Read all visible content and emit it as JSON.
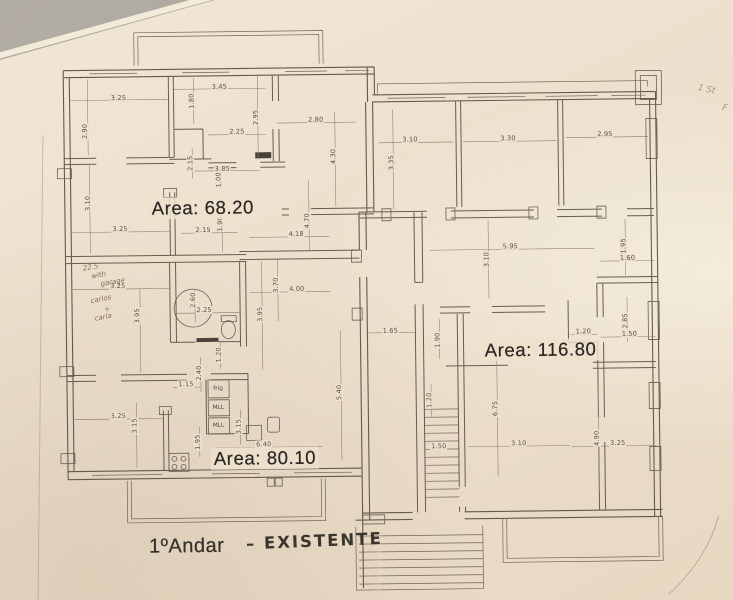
{
  "page": {
    "background_color": "#a6a199",
    "paper_color": "#ece0cd",
    "ink_color": "#635a4e"
  },
  "title": {
    "printed": "1ºAndar",
    "handwritten": "– EXISTENTE"
  },
  "area_labels": [
    {
      "t": "Area:  68.20",
      "x": 204,
      "y": 206
    },
    {
      "t": "Area:  116.80",
      "x": 540,
      "y": 352
    },
    {
      "t": "Area:  80.10",
      "x": 263,
      "y": 457
    }
  ],
  "dimension_labels": [
    {
      "t": "3.25",
      "x": 121,
      "y": 95
    },
    {
      "t": "2.90",
      "x": 87,
      "y": 128,
      "v": true
    },
    {
      "t": "3.45",
      "x": 222,
      "y": 85
    },
    {
      "t": "1.80",
      "x": 194,
      "y": 99,
      "v": true
    },
    {
      "t": "2.95",
      "x": 258,
      "y": 116,
      "v": true
    },
    {
      "t": "2.25",
      "x": 239,
      "y": 130
    },
    {
      "t": "2.80",
      "x": 318,
      "y": 119
    },
    {
      "t": "4.30",
      "x": 335,
      "y": 156,
      "v": true
    },
    {
      "t": "2.15",
      "x": 192,
      "y": 161,
      "v": true
    },
    {
      "t": "3.85",
      "x": 224,
      "y": 167
    },
    {
      "t": "1.00",
      "x": 220,
      "y": 178,
      "v": true
    },
    {
      "t": "3.10",
      "x": 89,
      "y": 200,
      "v": true
    },
    {
      "t": "3.25",
      "x": 121,
      "y": 226
    },
    {
      "t": "2.15",
      "x": 204,
      "y": 228
    },
    {
      "t": "1.90",
      "x": 221,
      "y": 222,
      "v": true
    },
    {
      "t": "4.18",
      "x": 297,
      "y": 233
    },
    {
      "t": "4.70",
      "x": 308,
      "y": 220,
      "v": true
    },
    {
      "t": "3.70",
      "x": 276,
      "y": 284,
      "v": true
    },
    {
      "t": "4.00",
      "x": 297,
      "y": 288
    },
    {
      "t": "3.25",
      "x": 118,
      "y": 283
    },
    {
      "t": "3.95",
      "x": 137,
      "y": 313,
      "v": true
    },
    {
      "t": "2.60",
      "x": 193,
      "y": 298,
      "v": true
    },
    {
      "t": "2.25",
      "x": 204,
      "y": 308
    },
    {
      "t": "3.95",
      "x": 260,
      "y": 313,
      "v": true
    },
    {
      "t": "1.20",
      "x": 218,
      "y": 353,
      "v": true
    },
    {
      "t": "2.40",
      "x": 198,
      "y": 371,
      "v": true
    },
    {
      "t": "1.15",
      "x": 185,
      "y": 382
    },
    {
      "t": "1.95",
      "x": 196,
      "y": 440,
      "v": true
    },
    {
      "t": "3.15",
      "x": 237,
      "y": 425,
      "v": true
    },
    {
      "t": "6.40",
      "x": 262,
      "y": 443
    },
    {
      "t": "3.25",
      "x": 117,
      "y": 413
    },
    {
      "t": "3.15",
      "x": 133,
      "y": 423,
      "v": true
    },
    {
      "t": "5.40",
      "x": 338,
      "y": 392,
      "v": true
    },
    {
      "t": "1.65",
      "x": 390,
      "y": 331
    },
    {
      "t": "1.90",
      "x": 437,
      "y": 341,
      "v": true
    },
    {
      "t": "3.10",
      "x": 412,
      "y": 140
    },
    {
      "t": "3.30",
      "x": 510,
      "y": 140
    },
    {
      "t": "2.95",
      "x": 607,
      "y": 137
    },
    {
      "t": "3.35",
      "x": 393,
      "y": 163,
      "v": true
    },
    {
      "t": "5.95",
      "x": 511,
      "y": 248
    },
    {
      "t": "3.10",
      "x": 487,
      "y": 261,
      "v": true
    },
    {
      "t": "1.95",
      "x": 624,
      "y": 249,
      "v": true
    },
    {
      "t": "1.60",
      "x": 628,
      "y": 261
    },
    {
      "t": "1.20",
      "x": 583,
      "y": 334
    },
    {
      "t": "2.85",
      "x": 625,
      "y": 324,
      "v": true
    },
    {
      "t": "1.50",
      "x": 629,
      "y": 337
    },
    {
      "t": "6.75",
      "x": 494,
      "y": 410,
      "v": true
    },
    {
      "t": "1.20",
      "x": 428,
      "y": 401,
      "v": true
    },
    {
      "t": "1.50",
      "x": 437,
      "y": 447
    },
    {
      "t": "3.10",
      "x": 517,
      "y": 445
    },
    {
      "t": "4.90",
      "x": 595,
      "y": 441,
      "v": true
    },
    {
      "t": "3.25",
      "x": 616,
      "y": 446
    }
  ],
  "appliance_labels": [
    {
      "t": "frig",
      "x": 217,
      "y": 387
    },
    {
      "t": "MLL",
      "x": 217,
      "y": 406
    },
    {
      "t": "MLL",
      "x": 217,
      "y": 424
    }
  ],
  "handwritten_notes": [
    {
      "t": "22.5",
      "x": 91,
      "y": 264,
      "r": -9
    },
    {
      "t": "with",
      "x": 99,
      "y": 272,
      "r": -9
    },
    {
      "t": "garage",
      "x": 113,
      "y": 279,
      "r": -9
    },
    {
      "t": "carlos",
      "x": 101,
      "y": 296,
      "r": -11
    },
    {
      "t": "+",
      "x": 107,
      "y": 306,
      "r": 0
    },
    {
      "t": "carla",
      "x": 103,
      "y": 314,
      "r": -11
    }
  ],
  "corner_note": [
    {
      "t": "1 St",
      "x": 709,
      "y": 94,
      "r": 13
    },
    {
      "t": "F",
      "x": 727,
      "y": 113,
      "r": 13
    }
  ]
}
